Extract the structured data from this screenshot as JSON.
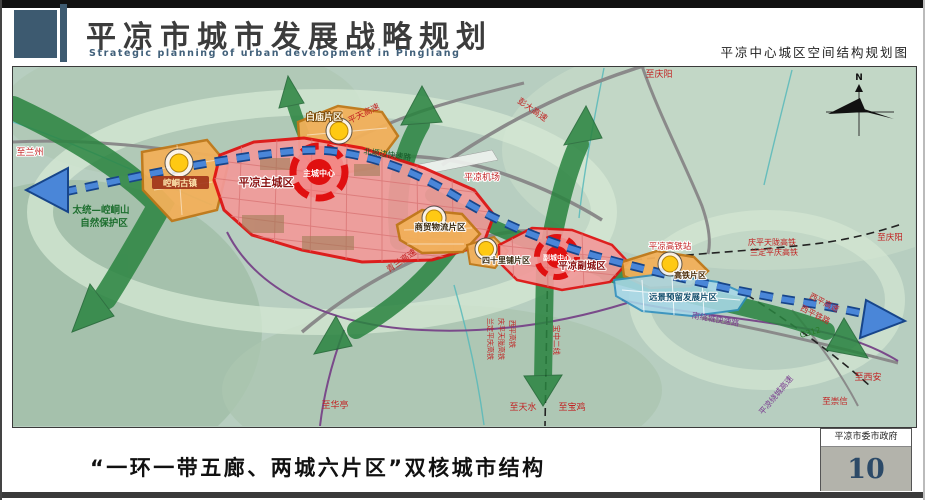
{
  "header": {
    "title": "平凉市城市发展战略规划",
    "subtitle_en": "Strategic planning of urban development in Pingliang",
    "map_title": "平凉中心城区空间结构规划图"
  },
  "footer": {
    "caption": "“一环一带五廊、两城六片区”双核城市结构",
    "agency": "平凉市委市政府",
    "page_number": "10"
  },
  "colors": {
    "accent_slate": "#3d5a70",
    "core_red": "#e01010",
    "zone_pink": "#f29a9a",
    "zone_orange": "#f2b05a",
    "reserve_blue": "#a8d8e8",
    "corridor_green": "#2a8440",
    "axis_blue": "#4a86d8",
    "label_red": "#c22222"
  },
  "map": {
    "compass_label": "N",
    "zones": {
      "kongtong_town": "崆峒古镇",
      "baimiao": "白庙片区",
      "main_city": "平凉主城区",
      "main_core": "主城中心",
      "trade_logistics": "商贸物流片区",
      "sishilipu": "四十里铺片区",
      "sub_city": "平凉副城区",
      "sub_core": "副城中心",
      "hsr_district": "高铁片区",
      "reserve": "远景预留发展片区",
      "nature_reserve_1": "太统—崆峒山",
      "nature_reserve_2": "自然保护区"
    },
    "labels": {
      "to_lanzhou": "至兰州",
      "pingtian_expwy": "平天高速",
      "pengda_expwy": "彭大高速",
      "to_qingyang_n": "至庆阳",
      "beiyuan_expwy": "北塬边快速路",
      "airport": "平凉机场",
      "qinglan_expwy": "青兰高速",
      "hsr_station": "平凉高铁站",
      "qpt_hsr": "庆平天陇高铁",
      "ldpq_hsr": "兰定平庆高铁",
      "to_qingyang_e": "至庆阳",
      "xiping_expwy": "西平高速",
      "xiping_rail": "西平铁路",
      "to_xian": "至西安",
      "to_chongxin": "至崇信",
      "ring_expwy": "平凉绕城高速",
      "south_ring_expwy": "南绕城快速路",
      "g312": "G312",
      "to_huating": "至华亭",
      "to_tianshui": "至天水",
      "to_baoji": "至宝鸡",
      "baozhong_line2": "宝中二线",
      "ldpq_hsr_v": "兰定平庆高铁",
      "qpt_hsr_v": "庆平天陇高铁",
      "xiping_hsr_v": "西平高铁"
    }
  }
}
